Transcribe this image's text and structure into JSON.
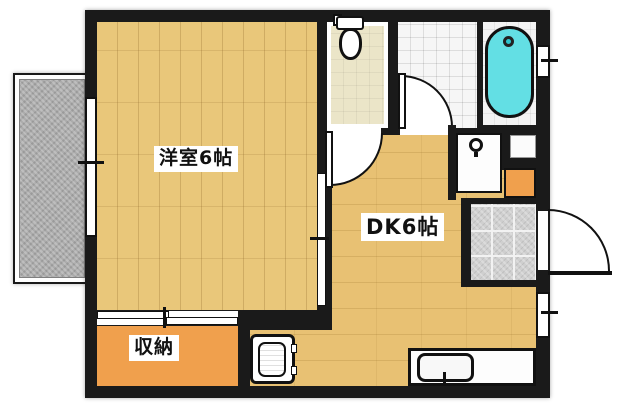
{
  "floorplan": {
    "title": "1DK apartment floor plan",
    "rooms": {
      "western_room": {
        "label": "洋室6帖",
        "type": "western-style room"
      },
      "dk": {
        "label": "DK6帖",
        "type": "dining kitchen"
      },
      "storage": {
        "label": "収納",
        "type": "closet"
      },
      "toilet": {
        "label": "",
        "type": "toilet room"
      },
      "bathroom": {
        "label": "",
        "type": "tiled washroom"
      },
      "bath": {
        "label": "",
        "type": "bathtub room"
      },
      "genkan": {
        "label": "",
        "type": "tiled entrance"
      },
      "balcony": {
        "label": "",
        "type": "balcony"
      }
    },
    "fixtures": [
      "toilet-icon",
      "bathtub-icon",
      "washing-machine-pan-icon",
      "kitchen-sink-icon",
      "washbasin-icon",
      "shoe-cabinet",
      "entrance-door-swing",
      "toilet-door-swing",
      "bathroom-door-swing",
      "sliding-door-closet",
      "sliding-door-partition",
      "window-balcony",
      "window-bath",
      "window-dk"
    ],
    "colors": {
      "wall": "#1a1a1a",
      "wood_floor": "#e9c77a",
      "dk_floor": "#e8c173",
      "storage_floor": "#f0a04d",
      "toilet_floor": "#ebe5c8",
      "bathtub": "#63dfe4",
      "balcony": "#acacac",
      "tile": "#cfcfcf"
    }
  }
}
